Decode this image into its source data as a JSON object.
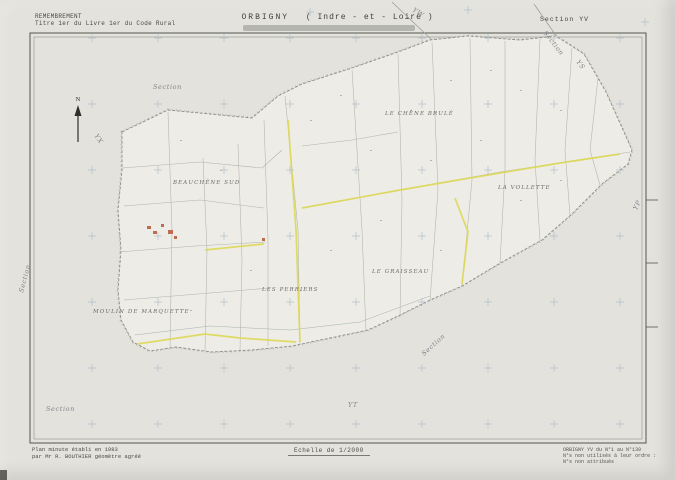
{
  "header": {
    "remembrement": "REMEMBREMENT",
    "code_rural": "Titre 1er du Livre 1er du Code Rural",
    "commune": "ORBIGNY",
    "departement": "( Indre - et - Loire )",
    "section": "Section YV"
  },
  "map": {
    "compass": "N",
    "sections": {
      "top_left": "Section",
      "left_margin": "Section",
      "yx": "YX",
      "yw": "YW",
      "top_right": "Section",
      "ys": "YS",
      "yp": "YP",
      "mid": "Section",
      "yt": "YT",
      "bottom_left": "Section"
    },
    "places": {
      "beauchene": "BEAUCHÊNE SUD",
      "chene_brule": "LE CHÊNE BRULÉ",
      "vollette": "LA VOLLETTE",
      "graisseau": "LE GRAISSEAU",
      "perriers": "LES PERRIERS",
      "moulin": "MOULIN DE MARQUETTE"
    },
    "colors": {
      "road_highlight": "#ddd855",
      "building": "#bc6c4f",
      "registration_cross": "#a9b8c4"
    }
  },
  "footer": {
    "plan_line1": "Plan minute établi en 1983",
    "plan_line2": "par Mr R. BOUTHIER géomètre agréé",
    "echelle": "Echelle de 1/2000",
    "right_line1": "ORBIGNY YV du N°1 au N°139",
    "right_line2": "N°s non utilisés à leur ordre :",
    "right_line3": "N°s non attribués"
  }
}
